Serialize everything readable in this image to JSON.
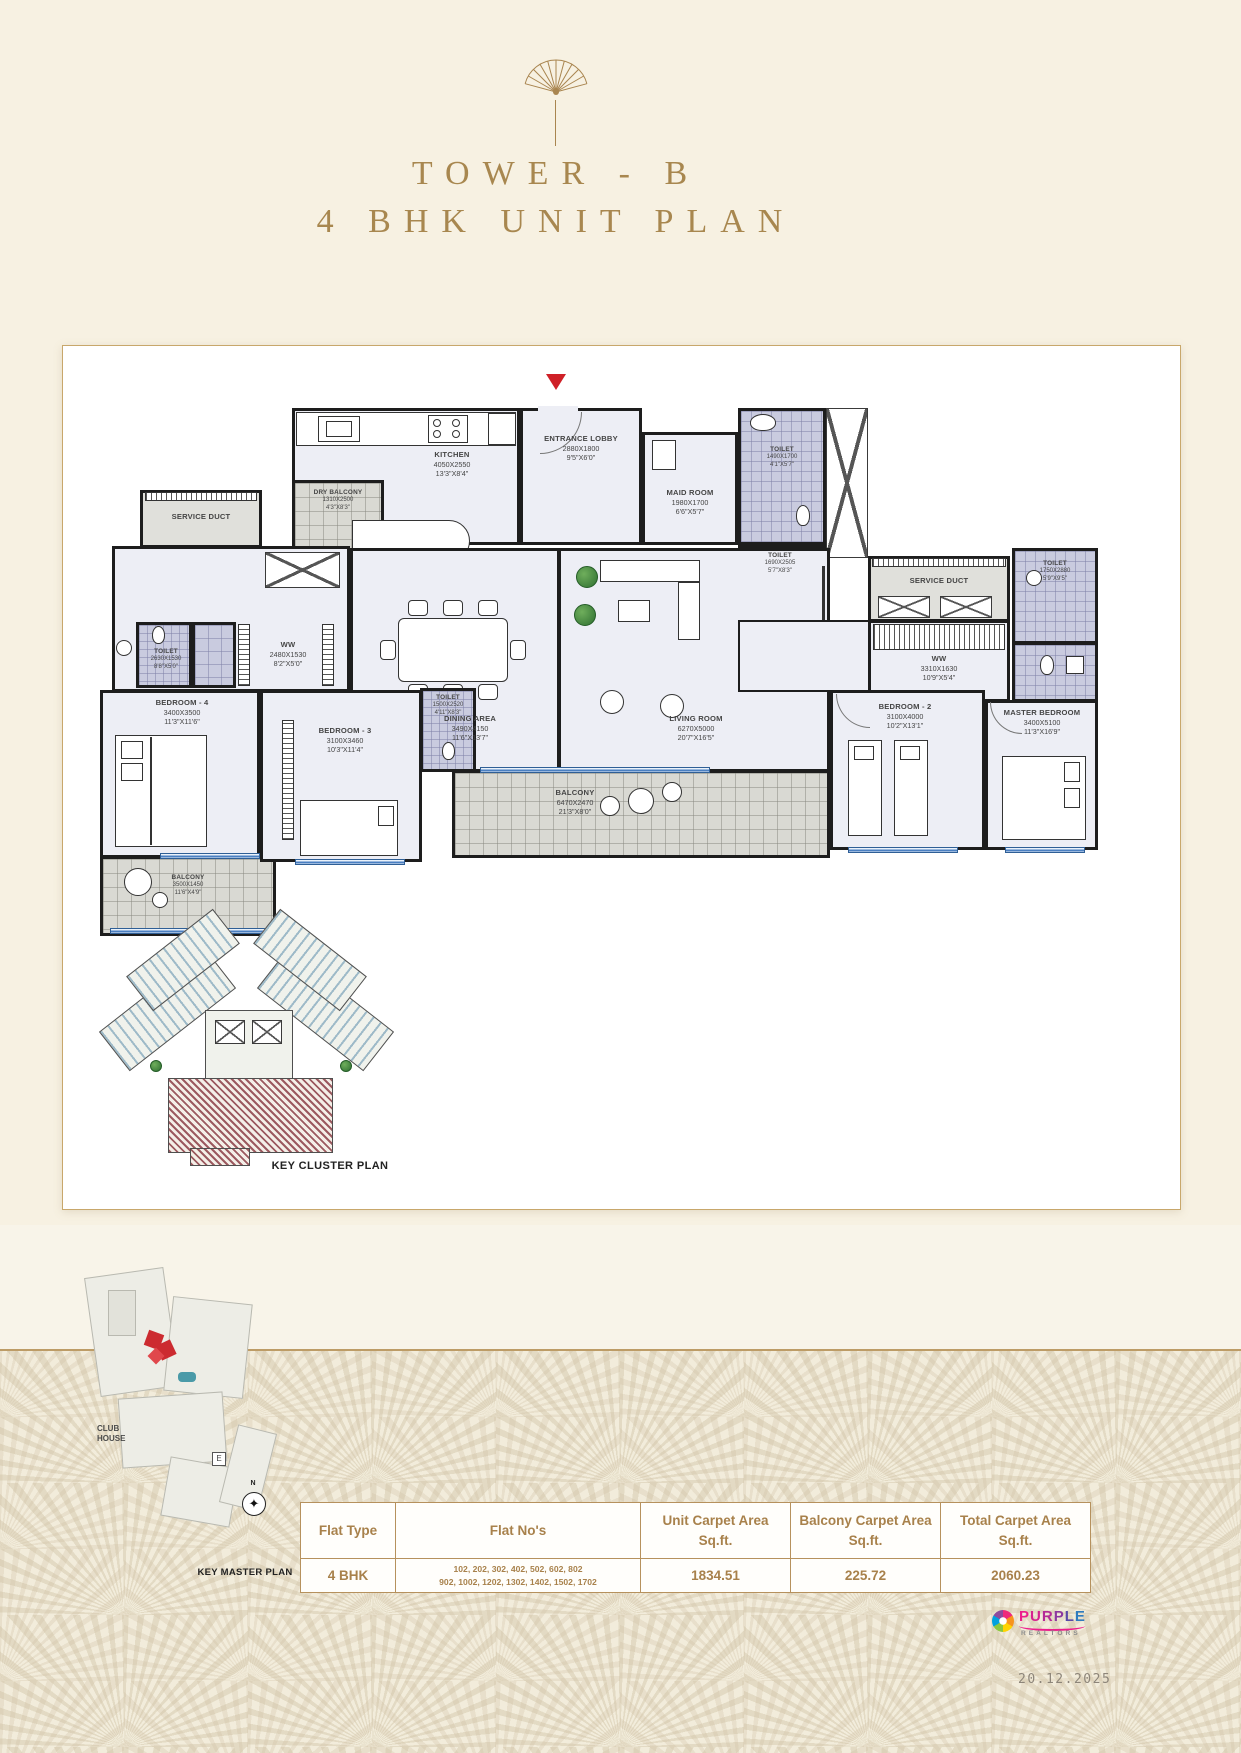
{
  "header": {
    "title_line1": "TOWER - B",
    "title_line2": "4 BHK UNIT PLAN"
  },
  "rooms": {
    "dry_balcony": {
      "name": "DRY BALCONY",
      "mm": "1310X2500",
      "ft": "4'3\"X8'3\""
    },
    "kitchen": {
      "name": "KITCHEN",
      "mm": "4050X2550",
      "ft": "13'3\"X8'4\""
    },
    "entrance_lobby": {
      "name": "ENTRANCE LOBBY",
      "mm": "2880X1800",
      "ft": "9'5\"X6'0\""
    },
    "maid_room": {
      "name": "MAID ROOM",
      "mm": "1980X1700",
      "ft": "6'6\"X5'7\""
    },
    "toilet_maid": {
      "name": "TOILET",
      "mm": "1490X1700",
      "ft": "4'1\"X5'7\""
    },
    "toilet_common": {
      "name": "TOILET",
      "mm": "1690X2505",
      "ft": "5'7\"X8'3\""
    },
    "service_duct_right": {
      "name": "SERVICE DUCT"
    },
    "toilet_master": {
      "name": "TOILET",
      "mm": "1750X2880",
      "ft": "5'9\"X9'5\""
    },
    "ww_master": {
      "name": "WW",
      "mm": "3310X1630",
      "ft": "10'9\"X5'4\""
    },
    "master_bedroom": {
      "name": "MASTER BEDROOM",
      "mm": "3400X5100",
      "ft": "11'3\"X16'9\""
    },
    "bedroom_2": {
      "name": "BEDROOM - 2",
      "mm": "3100X4000",
      "ft": "10'2\"X13'1\""
    },
    "living_room": {
      "name": "LIVING ROOM",
      "mm": "6270X5000",
      "ft": "20'7\"X16'5\""
    },
    "dining_area": {
      "name": "DINING AREA",
      "mm": "3490X4150",
      "ft": "11'6\"X13'7\""
    },
    "balcony_main": {
      "name": "BALCONY",
      "mm": "6470X2470",
      "ft": "21'3\"X8'0\""
    },
    "bedroom_3": {
      "name": "BEDROOM - 3",
      "mm": "3100X3460",
      "ft": "10'3\"X11'4\""
    },
    "toilet_bed3": {
      "name": "TOILET",
      "mm": "1500X2520",
      "ft": "4'11\"X8'3\""
    },
    "service_duct_left": {
      "name": "SERVICE DUCT"
    },
    "toilet_bed4": {
      "name": "TOILET",
      "mm": "2630X1530",
      "ft": "8'8\"X5'0\""
    },
    "ww_bed4": {
      "name": "WW",
      "mm": "2480X1530",
      "ft": "8'2\"X5'0\""
    },
    "bedroom_4": {
      "name": "BEDROOM - 4",
      "mm": "3400X3500",
      "ft": "11'3\"X11'6\""
    },
    "balcony_bed4": {
      "name": "BALCONY",
      "mm": "3500X1450",
      "ft": "11'6\"X4'9\""
    }
  },
  "keys": {
    "cluster_label": "KEY CLUSTER PLAN",
    "master_label": "KEY MASTER PLAN",
    "club_house": "CLUB HOUSE",
    "east_mark": "E",
    "north_mark": "N"
  },
  "table": {
    "headers": [
      "Flat Type",
      "Flat No's",
      "Unit Carpet Area Sq.ft.",
      "Balcony Carpet Area Sq.ft.",
      "Total Carpet Area Sq.ft."
    ],
    "row": {
      "flat_type": "4 BHK",
      "flat_nos_line1": "102, 202, 302, 402, 502, 602, 802",
      "flat_nos_line2": "902, 1002, 1202, 1302, 1402, 1502, 1702",
      "unit_area": "1834.51",
      "balcony_area": "225.72",
      "total_area": "2060.23"
    }
  },
  "logo": {
    "brand": "PURPLE",
    "sub": "REALTORS"
  },
  "footer": {
    "date": "20.12.2025"
  },
  "colors": {
    "gold": "#a8874f",
    "wall": "#1d1d1d",
    "accent_red": "#cf2027",
    "table_gold": "#b6915d"
  }
}
